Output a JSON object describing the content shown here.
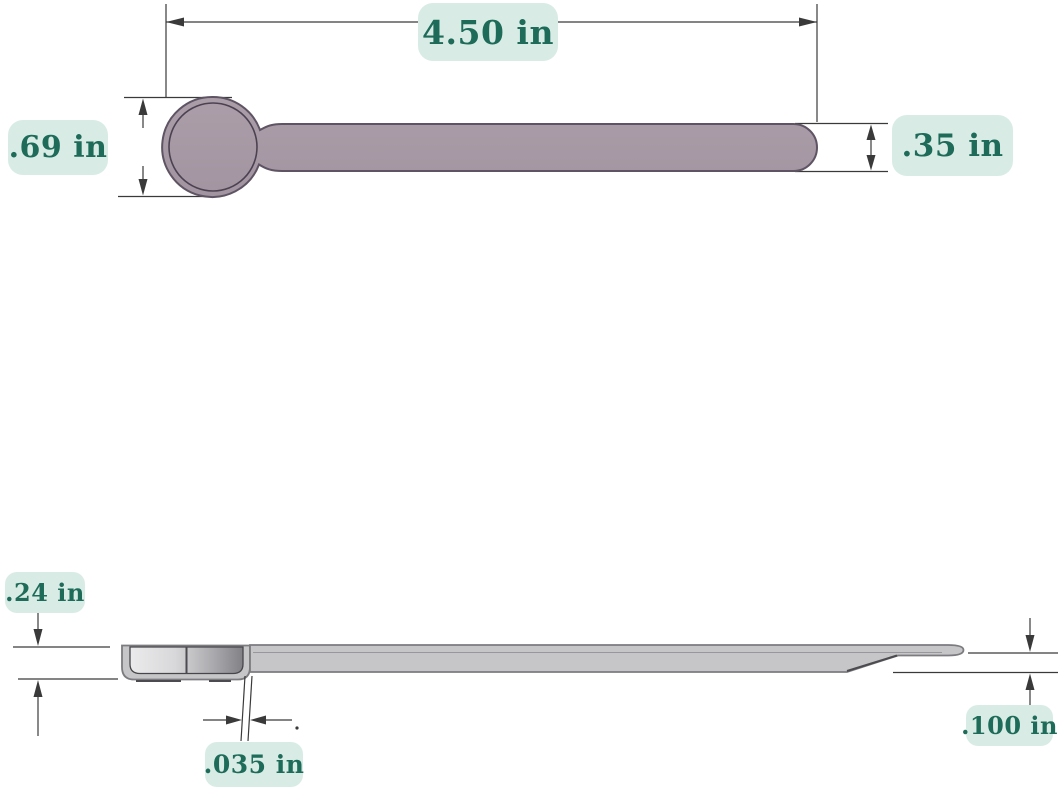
{
  "diagram": {
    "top_view": {
      "length_label": "4.50 in",
      "head_width_label": ".69 in",
      "handle_width_label": ".35 in"
    },
    "side_view": {
      "height_label": ".24 in",
      "thickness_label": ".035 in",
      "tip_height_label": ".100 in"
    }
  },
  "colors": {
    "background": "#ffffff",
    "label_bg": "#d8ece5",
    "label_text": "#1d6b58",
    "part_top_fill": "#a99ca7",
    "part_top_outline": "#5e5463",
    "part_side_fill": "#c6c6c8",
    "part_side_outline": "#7c7c80",
    "dim_line": "#3a3a3a"
  }
}
